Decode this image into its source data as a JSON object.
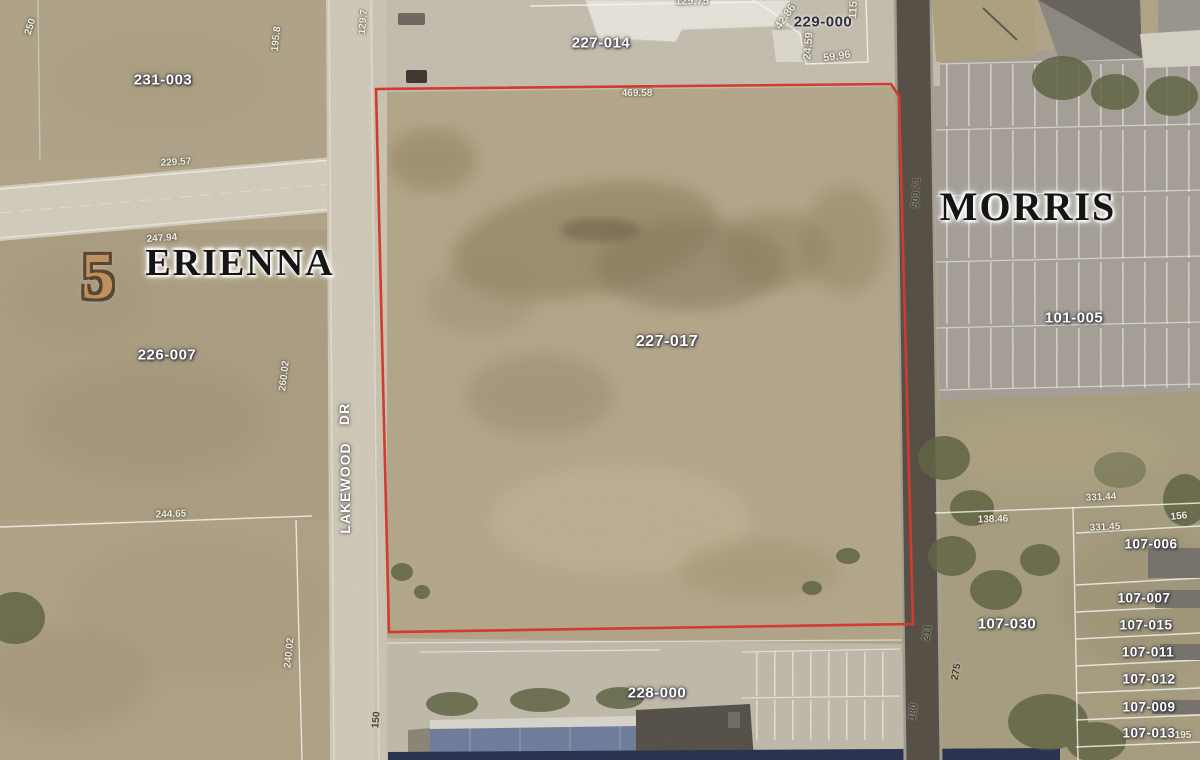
{
  "map": {
    "type": "aerial-parcel-map",
    "municipality_left": "ERIENNA",
    "municipality_right": "MORRIS",
    "highlighted_parcel_id": "227-017",
    "colors": {
      "highlight_outline": "#d23b2f",
      "parcel_label_fill": "#ffffff",
      "terrain_base": "#b4a78c"
    }
  },
  "labels": {
    "erienna": "ERIENNA",
    "morris": "MORRIS",
    "section5": "5",
    "lakewood": "LAKEWOOD",
    "dr": "DR",
    "p231_003": "231-003",
    "p227_014": "227-014",
    "p229_000": "229-000",
    "p226_007": "226-007",
    "p227_017": "227-017",
    "p228_000": "228-000",
    "p101_005": "101-005",
    "p107_006": "107-006",
    "p107_007": "107-007",
    "p107_015": "107-015",
    "p107_011": "107-011",
    "p107_012": "107-012",
    "p107_009": "107-009",
    "p107_013": "107-013",
    "p107_030": "107-030",
    "d129_75": "129.75",
    "d42_86": "42.86",
    "d115": "115",
    "d24_59": "24.59",
    "d59_96": "59.96",
    "d250": "250",
    "d195_8": "195.8",
    "d129_7": "129.7",
    "d229_57": "229.57",
    "d247_94": "247.94",
    "d244_65": "244.65",
    "d260_02": "260.02",
    "d240_02": "240.02",
    "d469_58": "469.58",
    "d509_71": "509.71",
    "d331_44": "331.44",
    "d331_45": "331.45",
    "d138_46": "138.46",
    "d156": "156",
    "d195": "195",
    "d211": "211",
    "d275": "275",
    "d180": "180",
    "d150": "150"
  }
}
